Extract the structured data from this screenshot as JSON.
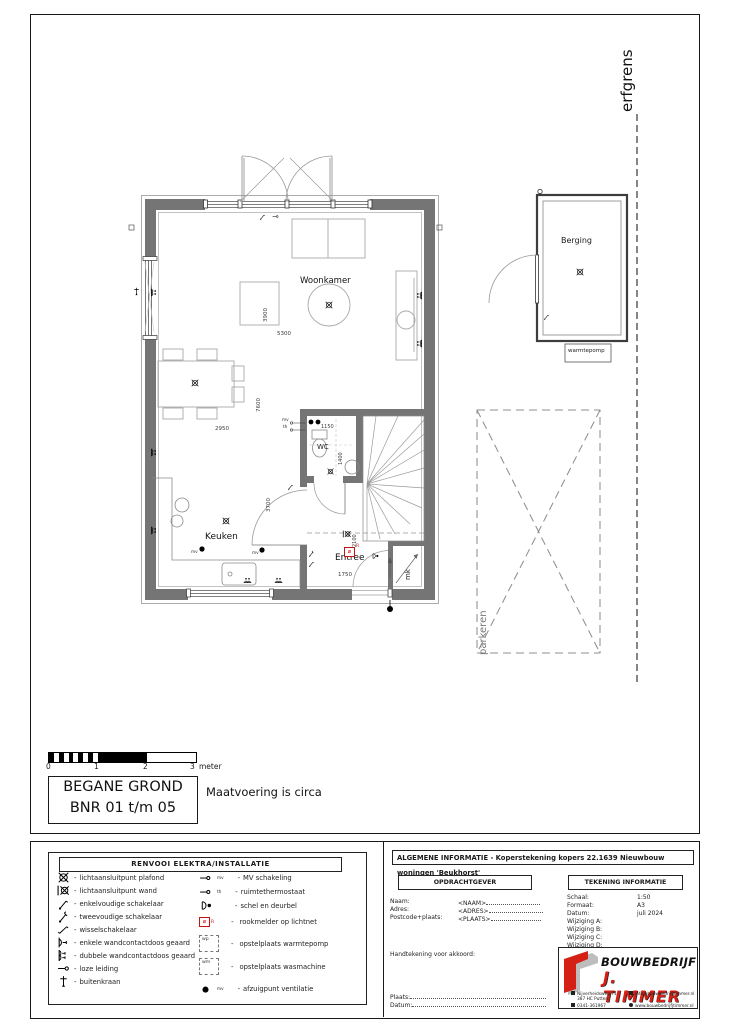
{
  "site": {
    "erfgrens": "erfgrens",
    "parkeren": "parkeren",
    "berging": "Berging",
    "warmtepomp": "warmtepomp"
  },
  "rooms": {
    "woonkamer": "Woonkamer",
    "keuken": "Keuken",
    "entree": "Entree",
    "wc": "WC",
    "mk": "mk"
  },
  "dimensions": {
    "woonkamer_breedte": "5300",
    "woonkamer_diepte": "3900",
    "totale_diepte": "7600",
    "keuken_breedte": "2950",
    "keuken_diepte": "3700",
    "wc_breedte": "1150",
    "wc_diepte": "1400",
    "entree_diepte": "2100",
    "entree_breedte": "1750"
  },
  "plan_marks": {
    "mv": "mv",
    "th": "th",
    "rookmelder_letter": "R"
  },
  "scalebar": {
    "ticks": [
      "0",
      "1",
      "2",
      "3"
    ],
    "unit": "meter"
  },
  "titlebox": {
    "line1": "BEGANE GROND",
    "line2": "BNR 01 t/m 05",
    "note": "Maatvoering is circa"
  },
  "legend": {
    "title": "RENVOOI   ELEKTRA/INSTALLATIE",
    "sep": "-",
    "left": [
      {
        "icon": "lamp-plafond-icon",
        "label": "lichtaansluitpunt plafond"
      },
      {
        "icon": "lamp-wand-icon",
        "label": "lichtaansluitpunt wand"
      },
      {
        "icon": "enkelvoudige-schakelaar-icon",
        "label": "enkelvoudige schakelaar"
      },
      {
        "icon": "tweevoudige-schakelaar-icon",
        "label": "tweevoudige schakelaar"
      },
      {
        "icon": "wisselschakelaar-icon",
        "label": "wisselschakelaar"
      },
      {
        "icon": "enkele-wandcontactdoos-icon",
        "label": "enkele wandcontactdoos geaard"
      },
      {
        "icon": "dubbele-wandcontactdoos-icon",
        "label": "dubbele wandcontactdoos geaard"
      },
      {
        "icon": "loze-leiding-icon",
        "label": "loze leiding"
      },
      {
        "icon": "buitenkraan-icon",
        "label": "buitenkraan"
      }
    ],
    "right": [
      {
        "icon": "mv-schakeling-icon",
        "label": "MV schakeling",
        "sup": "mv"
      },
      {
        "icon": "ruimtethermostaat-icon",
        "label": "ruimtethermostaat",
        "sup": "th"
      },
      {
        "icon": "schel-deurbel-icon",
        "label": "schel en deurbel"
      },
      {
        "icon": "rookmelder-icon",
        "label": "rookmelder op lichtnet",
        "letter": "R"
      },
      {
        "icon": "warmtepomp-box-icon",
        "label": "opstelplaats warmtepomp",
        "letter": "wp"
      },
      {
        "icon": "wasmachine-box-icon",
        "label": "opstelplaats wasmachine",
        "letter": "wm"
      },
      {
        "icon": "afzuigpunt-icon",
        "label": "afzuigpunt ventilatie",
        "sup": "mv"
      }
    ]
  },
  "titleblock": {
    "algemene_informatie": "ALGEMENE INFORMATIE - Koperstekening kopers 22.1639 Nieuwbouw woningen 'Beukhorst'",
    "opdrachtgever": {
      "title": "OPDRACHTGEVER",
      "fields": [
        {
          "label": "Naam:",
          "value": "<NAAM>"
        },
        {
          "label": "Adres:",
          "value": "<ADRES>"
        },
        {
          "label": "Postcode+plaats:",
          "value": "<PLAATS>"
        }
      ],
      "handtekening": "Handtekening voor akkoord:",
      "plaats": "Plaats:",
      "datum": "Datum:"
    },
    "tekening_informatie": {
      "title": "TEKENING INFORMATIE",
      "rows": [
        {
          "label": "Schaal:",
          "value": "1:50"
        },
        {
          "label": "Formaat:",
          "value": "A3"
        },
        {
          "label": "Datum:",
          "value": "juli 2024"
        },
        {
          "label": "Wijziging A:",
          "value": ""
        },
        {
          "label": "Wijziging B:",
          "value": ""
        },
        {
          "label": "Wijziging C:",
          "value": ""
        },
        {
          "label": "Wijziging D:",
          "value": ""
        }
      ]
    },
    "logo": {
      "line1": "BOUWBEDRIJF",
      "line2": "J. TIMMER",
      "contacts_left": [
        "Nijverheidsweg 71",
        "387 HC Putten",
        "0341-361967"
      ],
      "contacts_right": [
        "info@bouwbedrijfjtimmer.nl",
        "www.bouwbedrijfjtimmer.nl"
      ]
    }
  },
  "colors": {
    "wall": "#757575",
    "accent_red": "#cc1111",
    "line": "#333333"
  }
}
